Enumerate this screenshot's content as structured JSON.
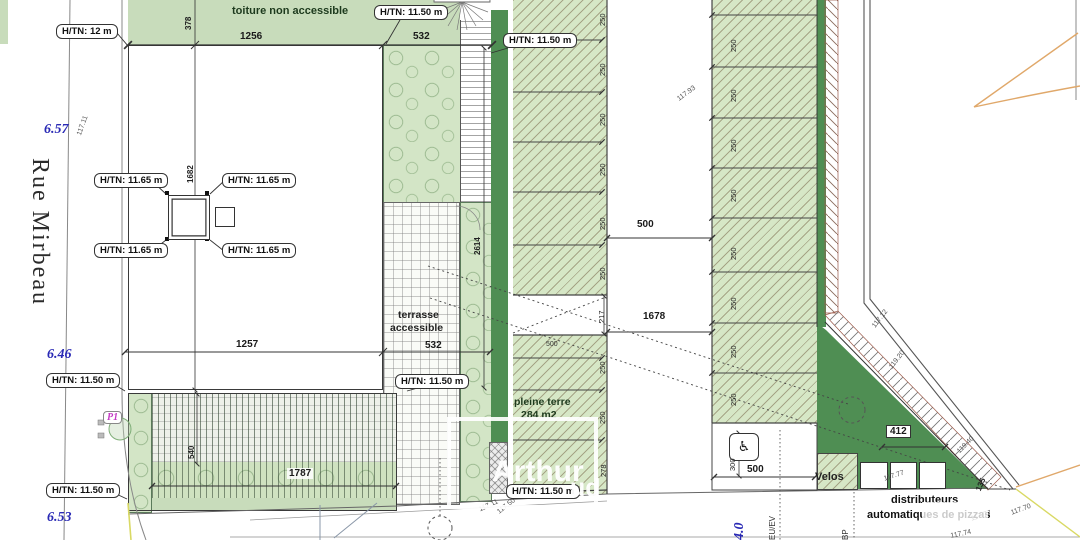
{
  "plan": {
    "street_name": "Rue Mirbeau",
    "watermark": {
      "line1": "Arthur",
      "line2": "ud"
    },
    "labels": {
      "roof": "toiture non accessible",
      "terrace1": "terrasse",
      "terrace2": "accessible",
      "pleine1": "pleine terre",
      "pleine2": "284 m2",
      "velos": "Velos",
      "distrib1": "distributeurs",
      "distrib2": "automatiques de pizzas",
      "p1": "P1"
    },
    "levels": {
      "l1": "6.57",
      "l2": "6.46",
      "l3": "6.53",
      "l4": "4.0"
    },
    "htn": [
      "H/TN: 12 m",
      "H/TN: 11.50 m",
      "H/TN: 11.50 m",
      "H/TN: 11.65 m",
      "H/TN: 11.65 m",
      "H/TN: 11.65 m",
      "H/TN: 11.65 m",
      "H/TN: 11.50 m",
      "H/TN: 11.50 m",
      "H/TN: 11.50 m",
      "H/TN: 11.50 m"
    ],
    "dims": {
      "w_roof": "1256",
      "w_terr_top": "532",
      "w_bldg": "1257",
      "w_terr_bot": "532",
      "h_roof": "378",
      "h_bldg": "1682",
      "h_terr": "2614",
      "h_slat": "540",
      "w_slat": "1787",
      "w_drive": "500",
      "l_drive": "1678",
      "h_gap": "217",
      "w_row": "500",
      "w_hc": "500",
      "h_hc": "300",
      "w_dist": "412",
      "h_dist": "135",
      "t250": "250",
      "t278": "278"
    },
    "elevations": {
      "e1": "117.11",
      "e2": "117.93",
      "e3": "117.12",
      "e4": "119.20",
      "e5": "119.40",
      "e6": "117.77",
      "e7": "117.77",
      "e8": "117.70",
      "e9": "117.74",
      "e10": "117.11",
      "e11": "117.50",
      "e12": "EU/EV",
      "e13": "BP"
    },
    "icons": {
      "wheelchair": "♿"
    }
  }
}
